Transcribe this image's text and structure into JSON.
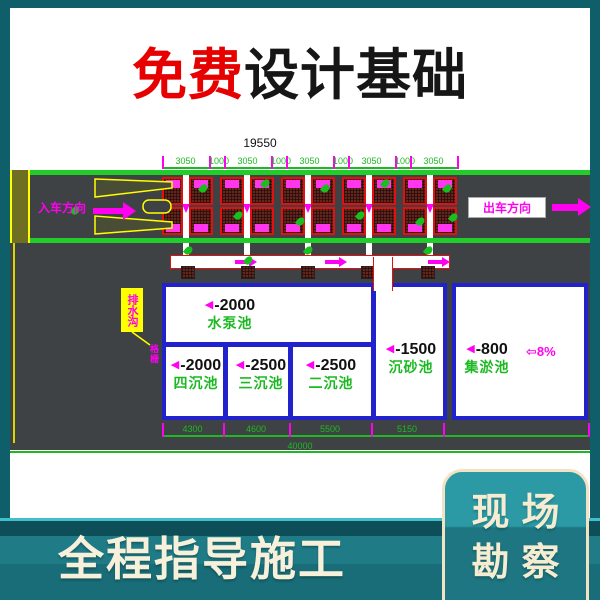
{
  "title": {
    "highlight": "免费",
    "rest": "设计基础",
    "highlight_color": "#e60000",
    "rest_color": "#161616"
  },
  "drawing": {
    "dim_total_top": "19550",
    "dim_segments_top": [
      "3050",
      "1000",
      "3050",
      "1000",
      "3050",
      "1000",
      "3050",
      "1000",
      "3050"
    ],
    "dim_segments_bottom": [
      "4300",
      "4600",
      "5500",
      "5150"
    ],
    "dim_total_bottom": "40000",
    "entry_label": "入车方向",
    "exit_label": "出车方向",
    "callout_label": "排水沟",
    "callout_small_label": "格栅",
    "slope_label": "⇦8%",
    "pools": [
      {
        "elev": "-2000",
        "name": "水泵池"
      },
      {
        "elev": "-2000",
        "name": "四沉池"
      },
      {
        "elev": "-2500",
        "name": "三沉池"
      },
      {
        "elev": "-2500",
        "name": "二沉池"
      },
      {
        "elev": "-1500",
        "name": "沉砂池"
      },
      {
        "elev": "-800",
        "name": "集淤池"
      }
    ],
    "colors": {
      "teal_bg": "#0e5f6a",
      "cad_green": "#22cd2b",
      "cad_magenta": "#ff00f0",
      "cad_blue": "#2222cc",
      "cad_red": "#e41010",
      "road_gray": "#3f4244",
      "accent_red": "#e60000",
      "cream": "#f6eedb"
    }
  },
  "footer": {
    "slogan": "全程指导施工",
    "badge_line1": "现场",
    "badge_line2": "勘察"
  }
}
